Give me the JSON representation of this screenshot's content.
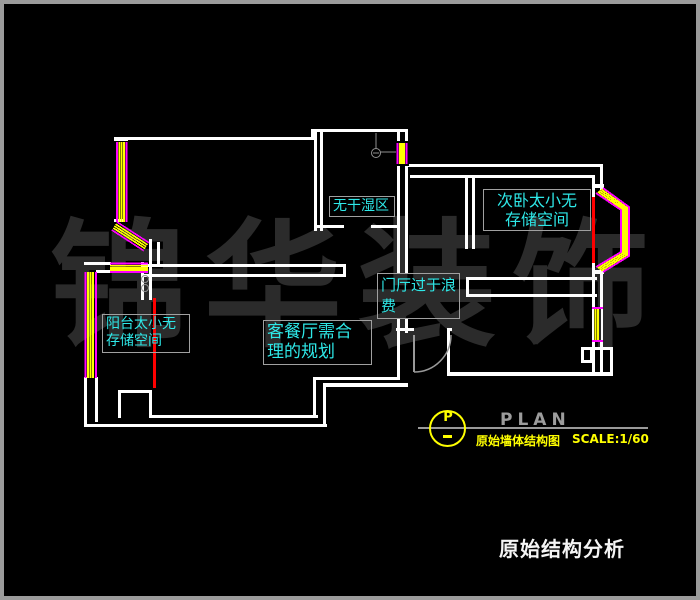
{
  "watermark": {
    "text": "锦华装饰"
  },
  "labels": {
    "bathroom": {
      "line1": "无干湿区"
    },
    "bedroom": {
      "line1": "次卧太小无",
      "line2": "存储空间"
    },
    "entry": {
      "line1": "门厅过于浪",
      "line2": "费"
    },
    "living": {
      "line1": "客餐厅需合",
      "line2": "理的规划"
    },
    "balcony": {
      "line1": "阳台太小无",
      "line2": "存储空间"
    }
  },
  "title_block": {
    "symbol_letter": "P",
    "symbol_dash": "-",
    "plan_label": "PLAN",
    "drawing_name": "原始墙体结构图",
    "scale": "SCALE:1/60"
  },
  "footer": {
    "title": "原始结构分析"
  },
  "colors": {
    "wall": "#ffffff",
    "window_glass": "#ffff00",
    "window_frame": "#ff00ff",
    "problem_wall": "#ff0000",
    "note_text": "#2ee8e8",
    "title_accent": "#ffff00",
    "watermark": "#2b2b2b"
  }
}
